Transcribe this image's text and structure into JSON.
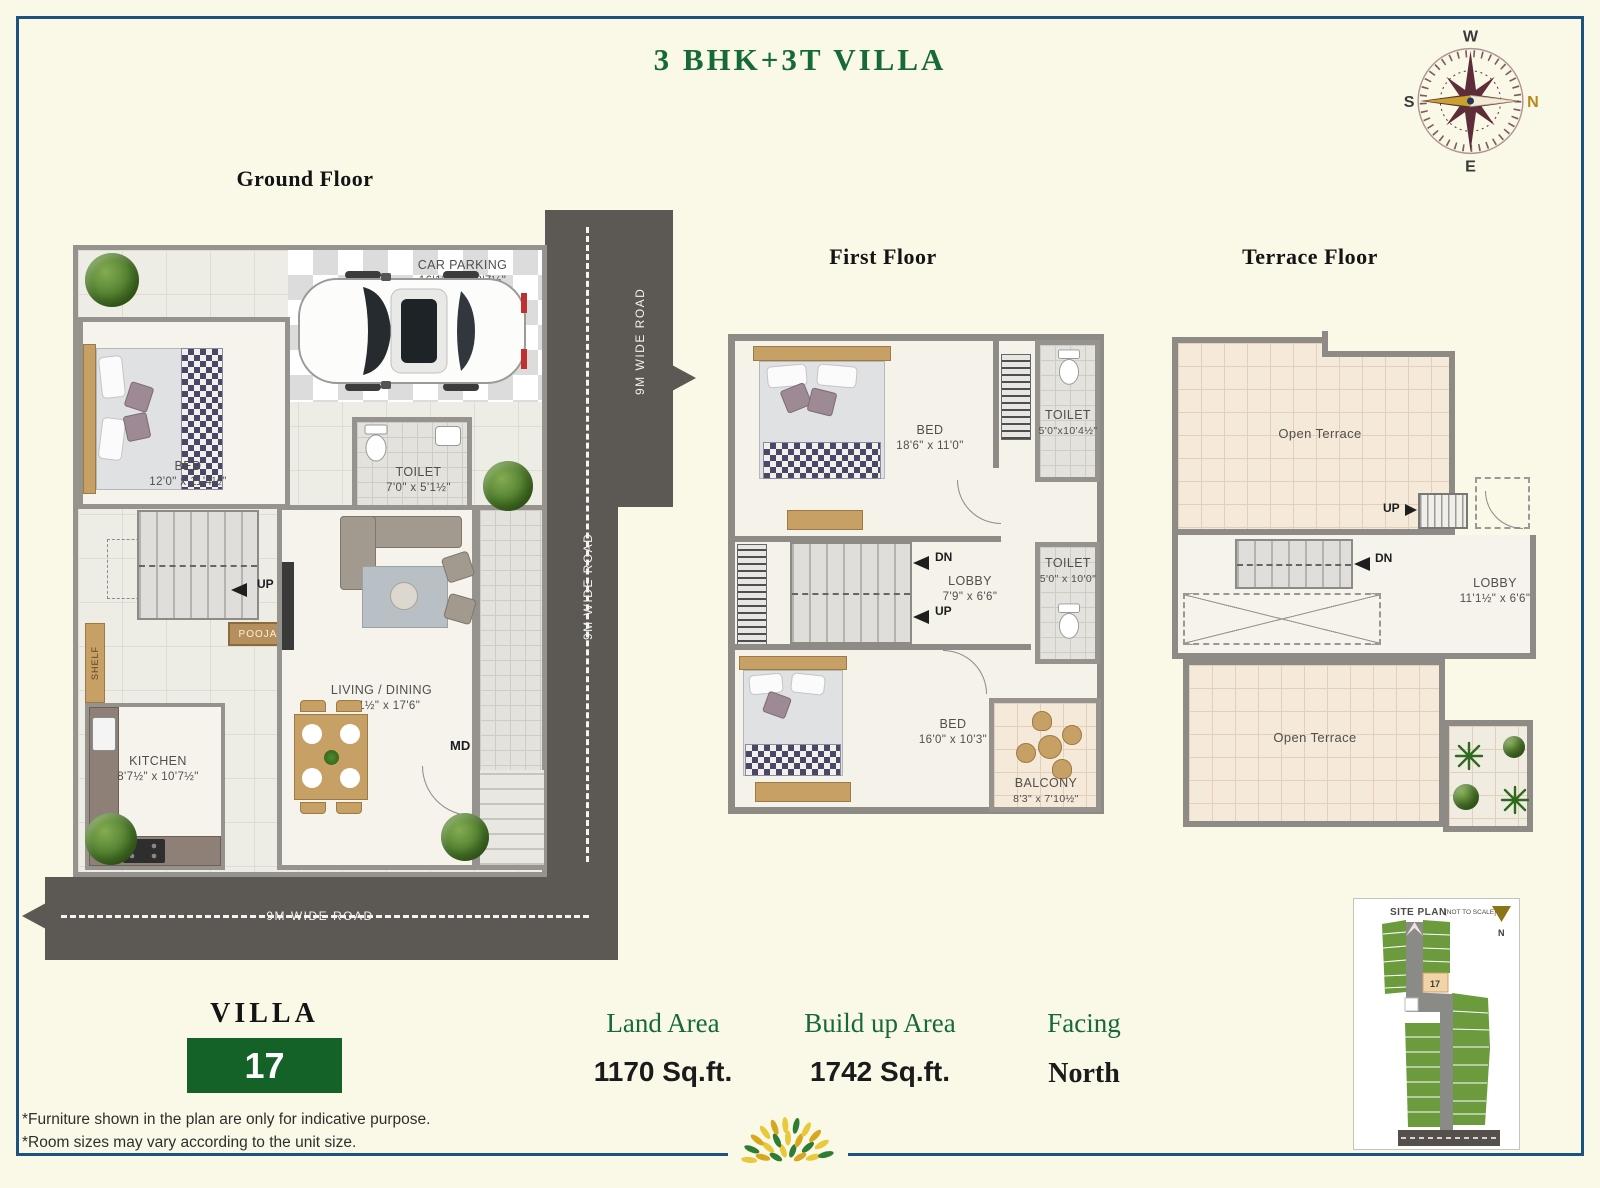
{
  "page": {
    "title": "3 BHK+3T VILLA"
  },
  "compass": {
    "n": "N",
    "e": "E",
    "s": "S",
    "w": "W"
  },
  "ground": {
    "heading": "Ground Floor",
    "car_parking_name": "CAR PARKING",
    "car_parking_dims": "16'11½\" x 8'7½\"",
    "bed_name": "BED",
    "bed_dims": "12'0\" x 11'4½\"",
    "toilet_name": "TOILET",
    "toilet_dims": "7'0\" x 5'1½\"",
    "kitchen_name": "KITCHEN",
    "kitchen_dims": "8'7½\" x 10'7½\"",
    "living_name": "LIVING / DINING",
    "living_dims": "11'1½\" x 17'6\"",
    "pooja": "POOJA",
    "shelf": "SHELF",
    "up": "UP",
    "md": "MD",
    "road_right_top": "9M WIDE ROAD",
    "road_right_bottom": "9M WIDE ROAD",
    "road_bottom": "9M WIDE ROAD"
  },
  "first": {
    "heading": "First Floor",
    "bed1_name": "BED",
    "bed1_dims": "18'6\" x 11'0\"",
    "toilet1_name": "TOILET",
    "toilet1_dims": "5'0\"x10'4½\"",
    "lobby_name": "LOBBY",
    "lobby_dims": "7'9\" x 6'6\"",
    "toilet2_name": "TOILET",
    "toilet2_dims": "5'0\" x 10'0\"",
    "bed2_name": "BED",
    "bed2_dims": "16'0\" x 10'3\"",
    "balcony_name": "BALCONY",
    "balcony_dims": "8'3\" x 7'10½\"",
    "dn": "DN",
    "up": "UP"
  },
  "terrace": {
    "heading": "Terrace Floor",
    "open_terrace_top": "Open Terrace",
    "open_terrace_bottom": "Open Terrace",
    "lobby_name": "LOBBY",
    "lobby_dims": "11'1½\" x 6'6\"",
    "dn": "DN",
    "up": "UP"
  },
  "info": {
    "villa_label": "VILLA",
    "villa_number": "17",
    "land_label": "Land Area",
    "land_value": "1170  Sq.ft.",
    "build_label": "Build up Area",
    "build_value": "1742 Sq.ft.",
    "facing_label": "Facing",
    "facing_value": "North"
  },
  "site_plan": {
    "title": "SITE PLAN",
    "subtitle": "[NOT TO SCALE]",
    "north": "N",
    "plot": "17"
  },
  "disclaimer": {
    "line1": "*Furniture shown in the plan are only for indicative purpose.",
    "line2": "*Room sizes may vary according to the unit size."
  },
  "colors": {
    "background": "#FAF8E6",
    "border": "#1C5380",
    "accent_green": "#156A38",
    "villa_box_green": "#156228",
    "road_gray": "#5C5854",
    "wall_gray": "#8E8B86",
    "site_plot_green": "#6B9B3D",
    "compass_maroon": "#5E2D3A",
    "compass_gold": "#C9A22E"
  }
}
